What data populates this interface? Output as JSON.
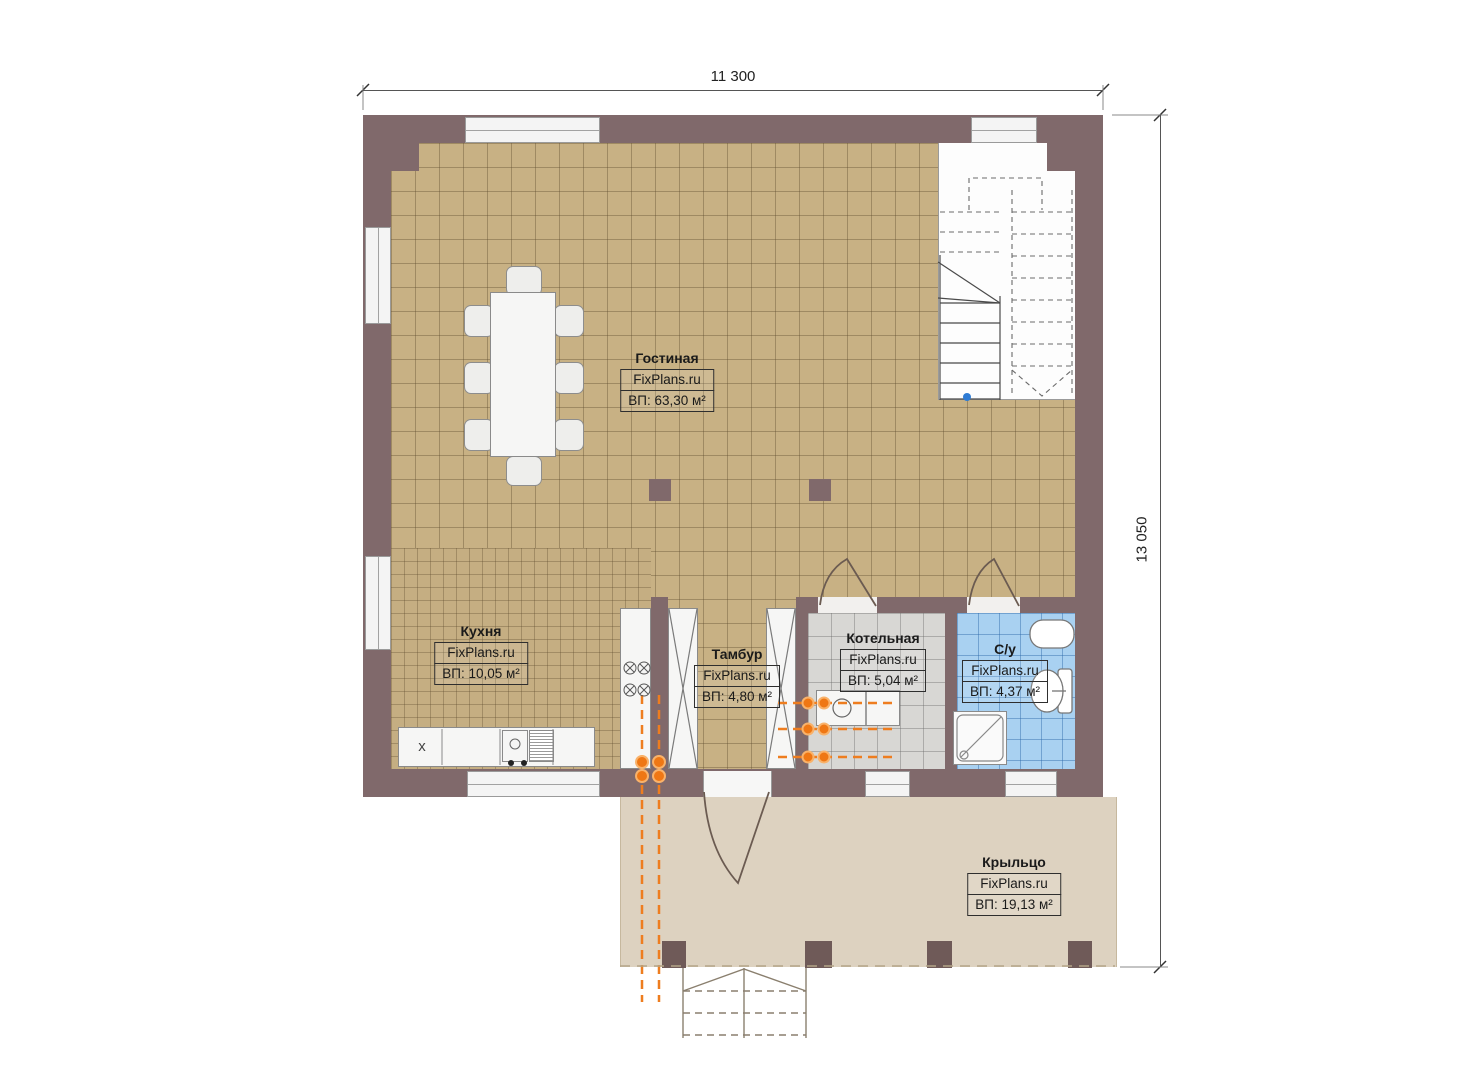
{
  "plan": {
    "type": "first-floor-plan",
    "watermark": "FixPlans.ru"
  },
  "dimensions": {
    "width_label": "11 300",
    "height_label": "13 050"
  },
  "rooms": [
    {
      "id": "living",
      "name": "Гостиная",
      "brand": "FixPlans.ru",
      "area": "ВП: 63,30 м²"
    },
    {
      "id": "kitchen",
      "name": "Кухня",
      "brand": "FixPlans.ru",
      "area": "ВП: 10,05 м²"
    },
    {
      "id": "tambour",
      "name": "Тамбур",
      "brand": "FixPlans.ru",
      "area": "ВП: 4,80 м²"
    },
    {
      "id": "boiler",
      "name": "Котельная",
      "brand": "FixPlans.ru",
      "area": "ВП: 5,04 м²"
    },
    {
      "id": "bathroom",
      "name": "С/у",
      "brand": "FixPlans.ru",
      "area": "ВП: 4,37 м²"
    },
    {
      "id": "porch",
      "name": "Крыльцо",
      "brand": "FixPlans.ru",
      "area": "ВП: 19,13 м²"
    }
  ],
  "fixtures": {
    "kitchen_marker": "x"
  },
  "colors": {
    "wall": "#80696b",
    "floor_tile_tan": "#c8b184",
    "boiler_floor_gray": "#d8d7d4",
    "bathroom_floor_blue": "#a9d1f1",
    "porch_floor": "#ddd2c0",
    "pipe_orange": "#ee7d1f",
    "stair_marker_blue": "#2e7bd4"
  }
}
